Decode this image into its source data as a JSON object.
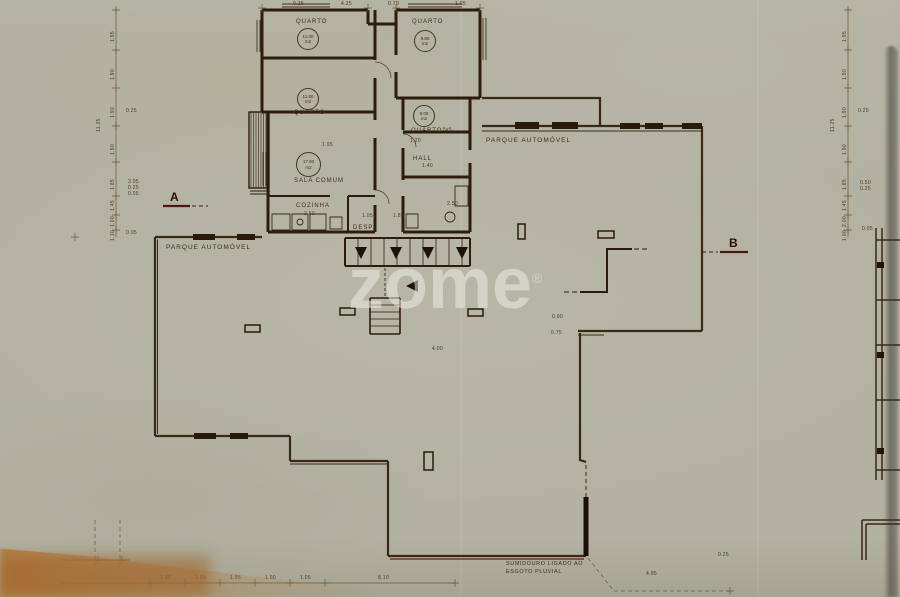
{
  "watermark": {
    "text": "zome",
    "mark": "®"
  },
  "section_markers": {
    "a": "A",
    "b": "B"
  },
  "rooms": [
    {
      "label": "QUARTO",
      "area": "11.00",
      "unit": "m2"
    },
    {
      "label": "QUARTO",
      "area": "11.50",
      "unit": "m2"
    },
    {
      "label": "QUARTO",
      "area": "9.80",
      "unit": "m2"
    },
    {
      "label": "QUARTO",
      "area": "9.00",
      "unit": "m2"
    },
    {
      "label": "SALA COMUM",
      "area": "17.80",
      "unit": "m2"
    }
  ],
  "room_labels": {
    "kitchen": "COZINHA",
    "hall": "HALL",
    "pantry": "DESP.",
    "parking_left": "PARQUE AUTOMÓVEL",
    "parking_right": "PARQUE AUTOMÓVEL"
  },
  "notes": {
    "drain_line1": "SUMIDOURO LIGADO AO",
    "drain_line2": "ESGOTO PLUVIAL"
  },
  "dimensions": {
    "top": [
      "0.25",
      "4.25",
      "0.70",
      "1.05"
    ],
    "left_overall": "11.25",
    "left_chain": [
      "1.95",
      "1.90",
      "1.90",
      "1.90",
      "1.85",
      "1.45",
      "1.00",
      "1.10"
    ],
    "left_marks": [
      "0.25",
      "3.05",
      "0.25",
      "0.05",
      "0.05"
    ],
    "right_overall": "11.25",
    "right_chain": [
      "1.95",
      "1.90",
      "1.90",
      "1.90",
      "1.85",
      "1.45",
      "2.00",
      "1.00"
    ],
    "right_marks": [
      "0.25",
      "0.50",
      "0.25",
      "0.05"
    ],
    "bottom": [
      "1.00",
      "1.00",
      "1.05",
      "1.00",
      "1.05",
      "8.10"
    ],
    "interior": [
      "2.50",
      "1.05",
      "1.85",
      "2.50",
      "1.95",
      "1.40",
      "1.20",
      "5x5",
      "0.90",
      "0.75",
      "4.00",
      "4.95",
      "0.25"
    ]
  },
  "colors": {
    "paper": "#b3b2a2",
    "ink": "#3a2817",
    "heavy_ink": "#1e1208",
    "stain": "#b27634"
  }
}
